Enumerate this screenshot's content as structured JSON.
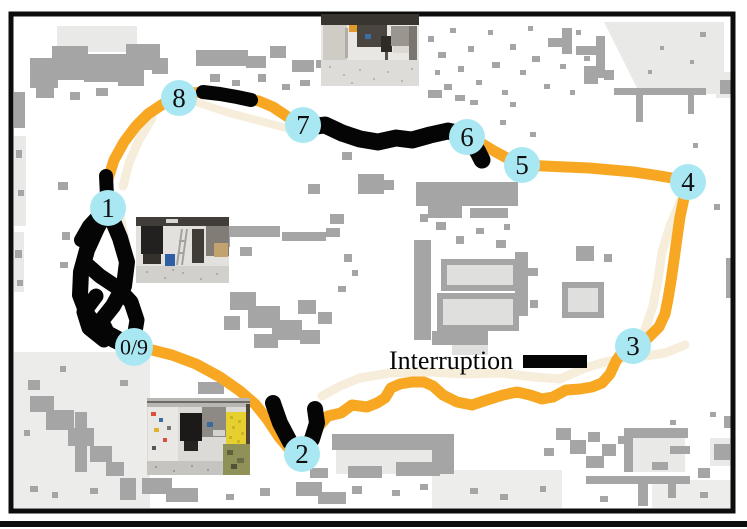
{
  "figure": {
    "title": "robot-trajectory-occupancy-map",
    "legend": {
      "label": "Interruption",
      "x": 389,
      "y": 369,
      "font_size": 26,
      "swatch": {
        "x": 523,
        "y": 355,
        "width": 64,
        "height": 13
      }
    },
    "colors": {
      "path": "#F7A722",
      "interruption": "#050505",
      "waypoint_fill": "#A9E8F2",
      "waypoint_text": "#101010",
      "reference_path": "#F6EDDA",
      "map_obstacle": "#A5A5A5",
      "map_light": "#E4E4E2",
      "frame": "#0d0d0d"
    },
    "waypoints": [
      {
        "label": "0/9",
        "x": 134,
        "y": 347,
        "r": 19,
        "fs": 22
      },
      {
        "label": "1",
        "x": 108,
        "y": 208,
        "r": 18,
        "fs": 27
      },
      {
        "label": "2",
        "x": 302,
        "y": 454,
        "r": 18,
        "fs": 27
      },
      {
        "label": "3",
        "x": 633,
        "y": 346,
        "r": 18,
        "fs": 27
      },
      {
        "label": "4",
        "x": 688,
        "y": 182,
        "r": 18,
        "fs": 27
      },
      {
        "label": "5",
        "x": 522,
        "y": 165,
        "r": 18,
        "fs": 27
      },
      {
        "label": "6",
        "x": 467,
        "y": 137,
        "r": 18,
        "fs": 27
      },
      {
        "label": "7",
        "x": 303,
        "y": 125,
        "r": 18,
        "fs": 27
      },
      {
        "label": "8",
        "x": 179,
        "y": 98,
        "r": 18,
        "fs": 27
      }
    ],
    "trajectory": {
      "loop_width": 11,
      "loop_points": [
        [
          134,
          347
        ],
        [
          152,
          350
        ],
        [
          172,
          355
        ],
        [
          196,
          364
        ],
        [
          220,
          377
        ],
        [
          240,
          391
        ],
        [
          255,
          404
        ],
        [
          267,
          419
        ],
        [
          279,
          437
        ],
        [
          291,
          451
        ],
        [
          302,
          454
        ],
        [
          312,
          441
        ],
        [
          319,
          426
        ],
        [
          328,
          416
        ],
        [
          341,
          413
        ],
        [
          352,
          405
        ],
        [
          367,
          407
        ],
        [
          377,
          403
        ],
        [
          385,
          398
        ],
        [
          391,
          388
        ],
        [
          400,
          384
        ],
        [
          412,
          382
        ],
        [
          424,
          382
        ],
        [
          433,
          386
        ],
        [
          443,
          395
        ],
        [
          457,
          402
        ],
        [
          472,
          405
        ],
        [
          487,
          400
        ],
        [
          503,
          395
        ],
        [
          517,
          392
        ],
        [
          530,
          395
        ],
        [
          542,
          399
        ],
        [
          553,
          397
        ],
        [
          566,
          390
        ],
        [
          580,
          389
        ],
        [
          592,
          387
        ],
        [
          602,
          383
        ],
        [
          610,
          374
        ],
        [
          616,
          361
        ],
        [
          623,
          351
        ],
        [
          633,
          346
        ],
        [
          648,
          338
        ],
        [
          659,
          327
        ],
        [
          665,
          314
        ],
        [
          668,
          299
        ],
        [
          671,
          281
        ],
        [
          674,
          260
        ],
        [
          677,
          238
        ],
        [
          680,
          217
        ],
        [
          684,
          198
        ],
        [
          688,
          182
        ],
        [
          672,
          178
        ],
        [
          654,
          175
        ],
        [
          634,
          172
        ],
        [
          612,
          170
        ],
        [
          589,
          168
        ],
        [
          566,
          167
        ],
        [
          544,
          166
        ],
        [
          522,
          165
        ],
        [
          507,
          158
        ],
        [
          494,
          151
        ],
        [
          481,
          143
        ],
        [
          467,
          137
        ],
        [
          451,
          131
        ],
        [
          433,
          134
        ],
        [
          415,
          139
        ],
        [
          397,
          137
        ],
        [
          379,
          141
        ],
        [
          361,
          138
        ],
        [
          346,
          132
        ],
        [
          331,
          126
        ],
        [
          317,
          124
        ],
        [
          303,
          125
        ],
        [
          288,
          117
        ],
        [
          273,
          107
        ],
        [
          259,
          101
        ],
        [
          246,
          99
        ],
        [
          232,
          96
        ],
        [
          218,
          93
        ],
        [
          205,
          92
        ],
        [
          192,
          93
        ],
        [
          179,
          98
        ],
        [
          163,
          104
        ],
        [
          148,
          114
        ],
        [
          136,
          126
        ],
        [
          124,
          142
        ],
        [
          114,
          160
        ],
        [
          108,
          179
        ],
        [
          106,
          195
        ],
        [
          108,
          208
        ],
        [
          99,
          227
        ],
        [
          89,
          248
        ],
        [
          82,
          270
        ],
        [
          81,
          293
        ],
        [
          87,
          314
        ],
        [
          99,
          330
        ],
        [
          113,
          340
        ],
        [
          126,
          346
        ],
        [
          134,
          347
        ]
      ],
      "interruptions": [
        {
          "w": 14,
          "points": [
            [
              203,
              92
            ],
            [
              220,
              94
            ],
            [
              237,
              97
            ],
            [
              251,
              100
            ]
          ]
        },
        {
          "w": 17,
          "points": [
            [
              309,
              127
            ],
            [
              325,
              125
            ],
            [
              342,
              133
            ],
            [
              360,
              139
            ],
            [
              378,
              142
            ],
            [
              396,
              138
            ],
            [
              412,
              140
            ],
            [
              430,
              135
            ],
            [
              448,
              131
            ],
            [
              462,
              134
            ],
            [
              471,
              141
            ],
            [
              478,
              152
            ],
            [
              482,
              160
            ]
          ]
        },
        {
          "w": 14,
          "points": [
            [
              106,
              176
            ],
            [
              107,
              196
            ]
          ]
        },
        {
          "w": 16,
          "points": [
            [
              273,
              403
            ],
            [
              280,
              423
            ],
            [
              290,
              442
            ],
            [
              302,
              454
            ],
            [
              312,
              439
            ],
            [
              317,
              423
            ],
            [
              315,
              409
            ]
          ]
        },
        {
          "w": 16,
          "points": [
            [
              108,
              208
            ],
            [
              97,
              228
            ],
            [
              87,
              250
            ],
            [
              81,
              272
            ],
            [
              80,
              295
            ],
            [
              88,
              316
            ],
            [
              100,
              330
            ],
            [
              114,
              340
            ],
            [
              127,
              346
            ],
            [
              134,
              347
            ]
          ]
        },
        {
          "w": 16,
          "points": [
            [
              110,
              214
            ],
            [
              120,
              238
            ],
            [
              127,
              262
            ],
            [
              124,
              286
            ],
            [
              113,
              306
            ],
            [
              101,
              321
            ],
            [
              107,
              333
            ],
            [
              122,
              341
            ]
          ]
        },
        {
          "w": 15,
          "points": [
            [
              84,
              262
            ],
            [
              100,
              276
            ],
            [
              118,
              288
            ],
            [
              131,
              302
            ],
            [
              137,
              320
            ],
            [
              134,
              338
            ]
          ]
        },
        {
          "w": 15,
          "points": [
            [
              96,
              296
            ],
            [
              84,
              312
            ],
            [
              89,
              328
            ],
            [
              104,
              340
            ]
          ]
        },
        {
          "w": 14,
          "points": [
            [
              101,
              213
            ],
            [
              89,
              226
            ],
            [
              81,
              240
            ]
          ]
        }
      ],
      "reference_segments": [
        {
          "w": 9,
          "points": [
            [
              322,
              396
            ],
            [
              340,
              386
            ],
            [
              360,
              378
            ],
            [
              390,
              373
            ],
            [
              430,
              372
            ],
            [
              465,
              374
            ],
            [
              500,
              373
            ],
            [
              535,
              377
            ],
            [
              560,
              379
            ],
            [
              585,
              368
            ],
            [
              605,
              362
            ],
            [
              625,
              358
            ],
            [
              645,
              356
            ],
            [
              665,
              353
            ],
            [
              685,
              345
            ]
          ]
        },
        {
          "w": 9,
          "points": [
            [
              120,
              216
            ],
            [
              126,
              244
            ],
            [
              124,
              272
            ],
            [
              128,
              300
            ],
            [
              136,
              326
            ],
            [
              144,
              345
            ]
          ]
        },
        {
          "w": 9,
          "points": [
            [
              681,
              200
            ],
            [
              670,
              226
            ],
            [
              662,
              252
            ],
            [
              658,
              280
            ],
            [
              653,
              306
            ],
            [
              645,
              330
            ]
          ]
        },
        {
          "w": 9,
          "points": [
            [
              152,
              118
            ],
            [
              139,
              140
            ],
            [
              129,
              163
            ],
            [
              123,
              186
            ]
          ]
        },
        {
          "w": 8,
          "points": [
            [
              196,
              102
            ],
            [
              226,
              112
            ],
            [
              256,
              120
            ],
            [
              286,
              128
            ]
          ]
        }
      ]
    },
    "photos": [
      {
        "name": "inset-photo-top",
        "x": 321,
        "y": 14,
        "w": 98,
        "h": 72
      },
      {
        "name": "inset-photo-middle",
        "x": 136,
        "y": 217,
        "w": 93,
        "h": 66
      },
      {
        "name": "inset-photo-bottom",
        "x": 147,
        "y": 398,
        "w": 103,
        "h": 77
      }
    ]
  }
}
